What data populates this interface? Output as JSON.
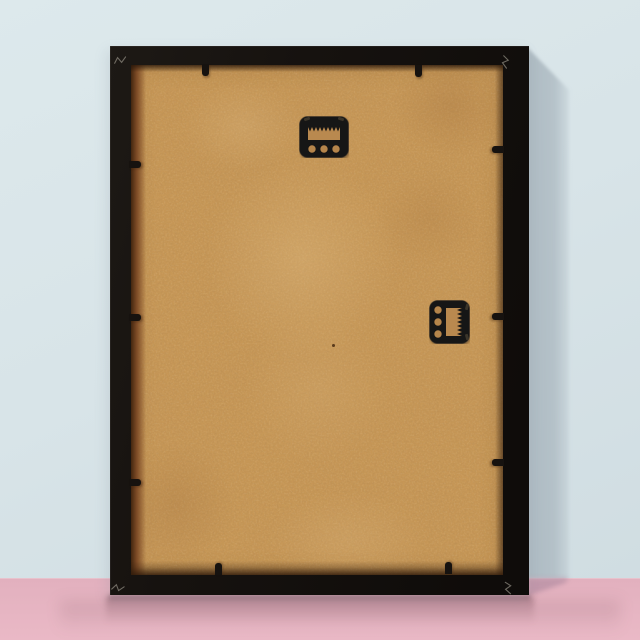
{
  "meta": {
    "type": "product-photograph",
    "subject": "Back of a black picture frame with tan MDF backing board, leaning against a pale blue wall on a pink floor",
    "width": 640,
    "height": 640
  },
  "colors": {
    "wall": "#d8e4e8",
    "wallTop": "#dde9ec",
    "wallBottom": "#cfdce1",
    "floor": "#e2b0be",
    "floorDeep": "#eab9c6",
    "junctionHighlight": "rgba(255,255,255,0.5)",
    "frame": "#16120f",
    "frameEdgeHighlight": "rgba(255,255,255,0.06)",
    "backing": "#c79756",
    "backingOpening": "#b9894f",
    "backingHole": "#b5854b",
    "recessDark": "#43260f",
    "recessBrown": "#7d4b26",
    "shadowWall": "#aab7bf",
    "shadowFloor": "#b38da2",
    "jointMark": "#8d887e",
    "speck": "#45290f",
    "hardware": "#181412",
    "hardwareEdge": "#3a342c"
  },
  "floor": {
    "top": 578
  },
  "wall_shadow": {
    "points": "527,47 569,90 569,578 527,578",
    "fade_from_x": 529,
    "fade_to_x": 575
  },
  "floor_shadow": {
    "points": "527,578 569,578 565,583 527,596",
    "opacity": 0.7
  },
  "frame": {
    "outer": {
      "x": 110,
      "y": 46,
      "w": 419,
      "h": 549
    },
    "backing": {
      "x": 131,
      "y": 65,
      "w": 372,
      "h": 510
    },
    "corner_joint_marks": [
      {
        "x": 113,
        "y": 50,
        "rot": -12
      },
      {
        "x": 498,
        "y": 53,
        "rot": 96
      },
      {
        "x": 111,
        "y": 578,
        "rot": 8
      },
      {
        "x": 501,
        "y": 579,
        "rot": 84
      }
    ],
    "retainer_tabs": [
      {
        "side": "top",
        "x": 202,
        "y": 64,
        "w": 7,
        "h": 12
      },
      {
        "side": "top",
        "x": 415,
        "y": 65,
        "w": 7,
        "h": 12
      },
      {
        "side": "left",
        "x": 129,
        "y": 161,
        "w": 12,
        "h": 7
      },
      {
        "side": "left",
        "x": 129,
        "y": 314,
        "w": 12,
        "h": 7
      },
      {
        "side": "left",
        "x": 129,
        "y": 479,
        "w": 12,
        "h": 7
      },
      {
        "side": "right",
        "x": 492,
        "y": 146,
        "w": 12,
        "h": 7
      },
      {
        "side": "right",
        "x": 492,
        "y": 313,
        "w": 12,
        "h": 7
      },
      {
        "side": "right",
        "x": 492,
        "y": 459,
        "w": 12,
        "h": 7
      },
      {
        "side": "bottom",
        "x": 215,
        "y": 563,
        "w": 7,
        "h": 12
      },
      {
        "side": "bottom",
        "x": 445,
        "y": 562,
        "w": 7,
        "h": 12
      }
    ],
    "hangers": [
      {
        "kind": "sawtooth-hanger",
        "orientation": "horizontal",
        "x": 299,
        "y": 116,
        "w": 50,
        "h": 42,
        "teeth": 8,
        "holes": 3
      },
      {
        "kind": "sawtooth-hanger",
        "orientation": "vertical",
        "x": 429,
        "y": 300,
        "w": 41,
        "h": 44,
        "teeth": 7,
        "holes": 3
      }
    ],
    "speck": {
      "x": 332,
      "y": 344
    }
  },
  "backing_patches": [
    {
      "cx": "46%",
      "cy": "38%",
      "w": "72%",
      "h": "55%",
      "color": "rgba(230,196,140,0.30)"
    },
    {
      "cx": "30%",
      "cy": "12%",
      "w": "45%",
      "h": "24%",
      "color": "rgba(228,194,142,0.22)"
    },
    {
      "cx": "86%",
      "cy": "8%",
      "w": "44%",
      "h": "28%",
      "color": "rgba(150,100,52,0.22)"
    },
    {
      "cx": "80%",
      "cy": "30%",
      "w": "40%",
      "h": "26%",
      "color": "rgba(155,105,55,0.16)"
    },
    {
      "cx": "12%",
      "cy": "86%",
      "w": "45%",
      "h": "34%",
      "color": "rgba(150,100,52,0.18)"
    },
    {
      "cx": "58%",
      "cy": "93%",
      "w": "60%",
      "h": "26%",
      "color": "rgba(226,192,142,0.18)"
    },
    {
      "cx": "50%",
      "cy": "64%",
      "w": "55%",
      "h": "40%",
      "color": "rgba(224,190,138,0.16)"
    }
  ],
  "reflections": {
    "main": {
      "x": 106,
      "y": 597,
      "w": 428,
      "h": 27
    },
    "wide": {
      "x": 60,
      "y": 601,
      "w": 560,
      "h": 32
    },
    "contact": {
      "x": 109,
      "y": 595,
      "w": 421,
      "h": 4
    }
  }
}
